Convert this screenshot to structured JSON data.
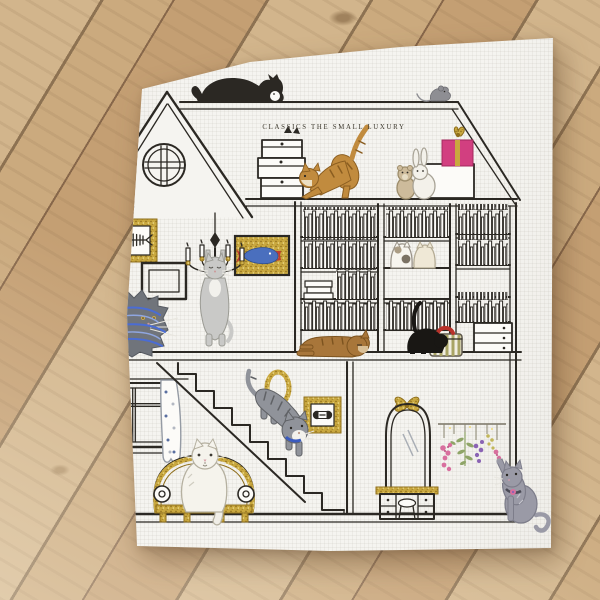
{
  "scene": {
    "description": "White linen handkerchief printed with a cat dollhouse illustration, photographed on a pale wooden plank floor",
    "brand_text": "CLASSICS THE SMALL LUXURY"
  },
  "objects": [
    "black-cat-on-roof",
    "mouse-on-roof",
    "gable-round-window",
    "stacked-boxes",
    "hiding-cat-ears",
    "stretching-ginger-cat",
    "teddy-bear-plush",
    "rabbit-plush",
    "white-box",
    "pink-gift-box",
    "fishbone-picture",
    "empty-frame",
    "gold-fish-picture",
    "chandelier",
    "hanging-gray-cat",
    "yarn-tangled-fluffy-cat",
    "bookshelf",
    "shelf-cats-pair",
    "black-cat-with-basket",
    "sleeping-brown-cat",
    "drawer-chest",
    "window-with-curtains",
    "staircase",
    "tabby-cat-on-stairs",
    "gold-oval-ornament",
    "framed-dumbbell-picture",
    "gold-settee-sofa",
    "white-longhair-cat-on-sofa",
    "arched-mirror",
    "dressing-table",
    "stool",
    "hanging-dried-flowers",
    "reaching-gray-cat"
  ],
  "palette": {
    "ink": "#2b2823",
    "cloth": "#f5f4f0",
    "white_warm": "#fcfbf8",
    "text_color": "#3b372c",
    "wood_a": "#d2b58c",
    "wood_b": "#c49f73",
    "wood_c": "#cbaa7e",
    "seam": "#8d7252",
    "gold": "#c9a83f",
    "gold_dark": "#8f6f1d",
    "gold_light": "#eedd8f",
    "gift_pink": "#d23f80",
    "fish_blue": "#4a6fbe",
    "fish_red": "#c03a2e",
    "ginger": "#c18b3e",
    "ginger_dark": "#8a5d20",
    "brown": "#a8763a",
    "brown_dark": "#7c531f",
    "gray_cat": "#c9c9c7",
    "gray_edge": "#9b9b94",
    "fluffy_gray": "#70747b",
    "fluffy_edge": "#565a61",
    "tabby": "#90939a",
    "tabby_dark": "#5f6165",
    "yarn_blue": "#4a6cd4",
    "yarn_light": "#8fa6e0",
    "russian": "#9a9aa6",
    "russian_edge": "#7d7d8a",
    "collar_blue": "#3a5bbf",
    "dot_blue": "#5a6fa0",
    "dot_gray": "#b3b8c2",
    "flower_pink": "#d86f9e",
    "flower_purple": "#8a63b4",
    "leaf_green": "#8fa568",
    "mimosa": "#c2b75a",
    "basket_olive": "#a9a465",
    "red_item": "#b8322a",
    "cream_cat": "#efe8d6",
    "patch_brown": "#ab9d85",
    "patch_dark": "#7b7264",
    "plush_bear": "#cdbb9b"
  }
}
